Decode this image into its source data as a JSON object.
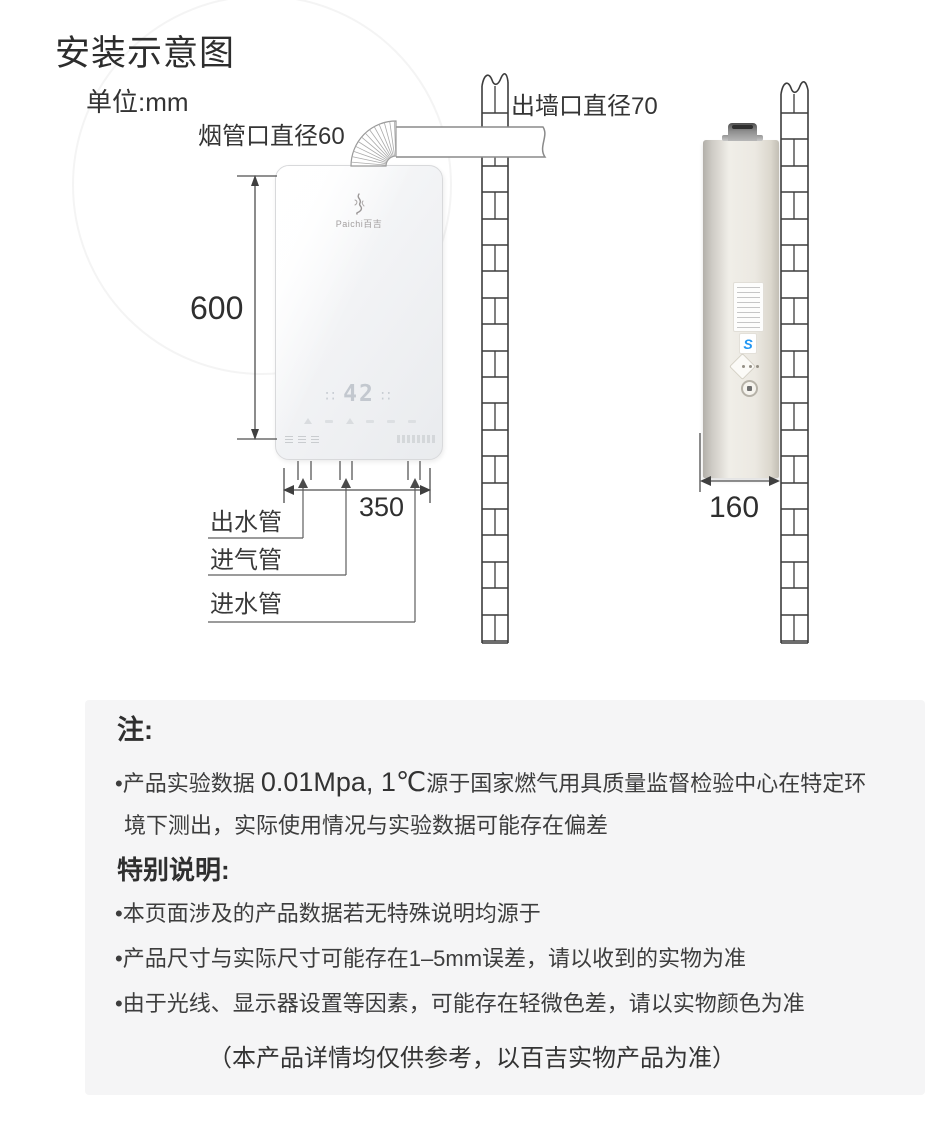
{
  "title": "安装示意图",
  "unit_label": "单位:mm",
  "diagram": {
    "flue_label": "烟管口直径60",
    "wall_outlet_label": "出墙口直径70",
    "height_dim": "600",
    "width_dim": "350",
    "depth_dim": "160",
    "pipe_labels": [
      "出水管",
      "进气管",
      "进水管"
    ],
    "front_view": {
      "brand": "Paichi百吉",
      "display_temp": "42",
      "display_dots_left": "∷",
      "display_dots_right": "∷"
    },
    "side_view": {
      "badge_letter": "S"
    }
  },
  "notes": {
    "title": "注:",
    "line1_prefix": "•产品实验数据 ",
    "line1_em": "0.01Mpa, 1℃",
    "line1_suffix": "源于国家燃气用具质量监督检验中心在特定环",
    "line2": "境下测出，实际使用情况与实验数据可能存在偏差"
  },
  "special": {
    "title": "特别说明:",
    "items": [
      "•本页面涉及的产品数据若无特殊说明均源于",
      "•产品尺寸与实际尺寸可能存在1–5mm误差，请以收到的实物为准",
      "•由于光线、显示器设置等因素，可能存在轻微色差，请以实物颜色为准"
    ]
  },
  "footer": "（本产品详情均仅供参考，以百吉实物产品为准）",
  "colors": {
    "panel_bg": "#f5f5f6",
    "line_art": "#4f4f4f",
    "wall_stroke": "#3d3d3d",
    "badge_blue": "#2196f3"
  }
}
